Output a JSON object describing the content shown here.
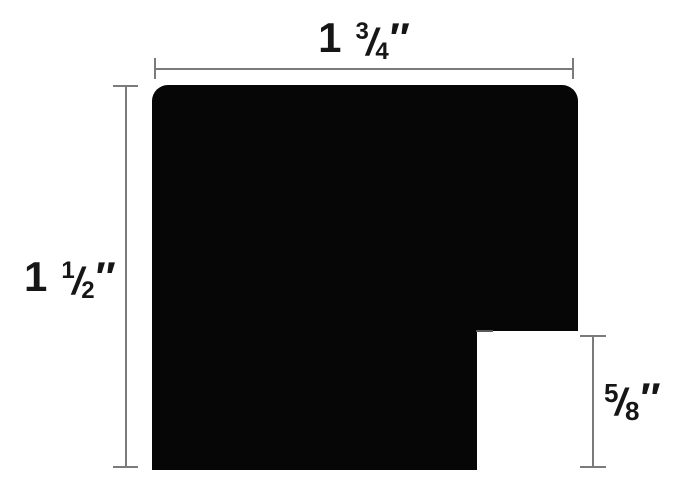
{
  "colors": {
    "background": "#ffffff",
    "shape": "#060606",
    "dimension_line": "#7b7b7b",
    "text": "#161616"
  },
  "dimensions": {
    "top_width": {
      "text": "1 3/4″",
      "whole": "1",
      "numerator": "3",
      "slash": "/",
      "denominator": "4",
      "unit_mark": "″"
    },
    "left_height": {
      "text": "1 1/2″",
      "whole": "1",
      "numerator": "1",
      "slash": "/",
      "denominator": "2",
      "unit_mark": "″"
    },
    "right_rabbet_depth": {
      "text": "5/8″",
      "numerator": "5",
      "slash": "/",
      "denominator": "8",
      "unit_mark": "″"
    }
  }
}
